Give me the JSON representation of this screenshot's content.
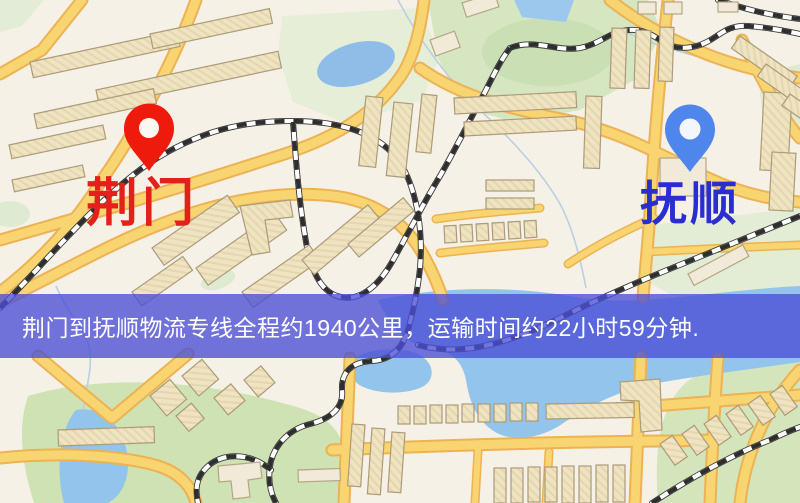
{
  "map": {
    "origin": {
      "label": "荆门",
      "label_color": "#e3201a",
      "pin_color": "#ee1b0d",
      "pin_hole_color": "#fdf7f2"
    },
    "destination": {
      "label": "抚顺",
      "label_color": "#2a2ed2",
      "pin_color": "#4f86ec",
      "pin_hole_color": "#f3f6fb"
    },
    "banner": {
      "text": "荆门到抚顺物流专线全程约1940公里，运输时间约22小时59分钟.",
      "bg_color": "rgba(74,78,214,0.78)",
      "text_color": "#ffffff"
    },
    "palette": {
      "background": "#f6f1e7",
      "road_fill": "#f8d571",
      "road_casing": "#ecb254",
      "water": "#93c4ec",
      "park": "#d6e6c1",
      "building": "#efe3c2",
      "railway": "#2e2e2e"
    }
  }
}
